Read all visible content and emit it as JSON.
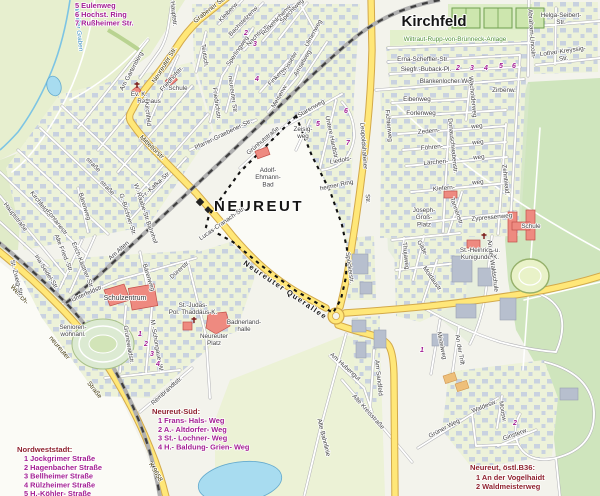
{
  "colors": {
    "road_major_fill": "#ffe778",
    "road_major_casing": "#d3a94a",
    "water": "#a8dcf0",
    "forest": "#cfe5bd",
    "residential": "#edf2d9",
    "building": "#c7d0e0",
    "landmark_red": "#ee8a80",
    "boundary": "#111111",
    "legend_magenta": "#a21a92",
    "legend_dark_red": "#8e1f2c",
    "green_label": "#4b8f2f",
    "water_label": "#3a8fc0"
  },
  "map": {
    "district_label": "NEUREUT",
    "quarter_label": "Kirchfeld",
    "labels": [
      {
        "n": "neureuter-str",
        "t": "Neureuter Str.",
        "x": 166,
        "y": 66,
        "r": -58,
        "k": "road"
      },
      {
        "n": "mitteltorstr",
        "t": "Mitteltorstr.",
        "x": 151,
        "y": 149,
        "r": 44,
        "k": "road"
      },
      {
        "n": "grabener-str",
        "t": "Grabener Str.",
        "x": 211,
        "y": 11,
        "r": -38,
        "k": "road"
      },
      {
        "n": "welsch",
        "t": "Welsch-",
        "x": 18,
        "y": 296,
        "r": 48,
        "k": "road"
      },
      {
        "n": "welsch-neureuter",
        "t": "neureuter",
        "x": 58,
        "y": 349,
        "r": 50,
        "k": "road"
      },
      {
        "n": "welsch-strasse",
        "t": "Straße",
        "x": 93,
        "y": 391,
        "r": 52,
        "k": "road"
      },
      {
        "n": "k9658",
        "t": "K 9658",
        "x": 154,
        "y": 473,
        "r": 60,
        "k": "road"
      },
      {
        "n": "neureuter-querallee",
        "t": "Neureuter Querallee",
        "x": 284,
        "y": 292,
        "r": 34,
        "k": "qall"
      },
      {
        "n": "leopoldshafener",
        "t": "Leopoldshafener",
        "x": 362,
        "y": 146,
        "r": 86
      },
      {
        "n": "leopoldshafener-str",
        "t": "Str.",
        "x": 366,
        "y": 199,
        "r": 86
      },
      {
        "n": "hauptstr-nord",
        "t": "Hauptstr.",
        "x": 172,
        "y": 14,
        "r": 84
      },
      {
        "n": "am-gartenberg",
        "t": "Am Gartenberg",
        "x": 133,
        "y": 72,
        "r": -62
      },
      {
        "n": "friedhofstr",
        "t": "Friedhofstr.",
        "x": 173,
        "y": 80,
        "r": -48
      },
      {
        "n": "schule-dorf",
        "t": "Schule",
        "x": 178,
        "y": 90
      },
      {
        "n": "ev-k",
        "t": "Ev. K.",
        "x": 139,
        "y": 96
      },
      {
        "n": "rathaus",
        "t": "Rathaus",
        "x": 149,
        "y": 103
      },
      {
        "n": "kirchfeld-vert",
        "t": "Kirchfeld",
        "x": 146,
        "y": 114,
        "r": 84
      },
      {
        "n": "hauptstrasse",
        "t": "Hauptstraße",
        "x": 14,
        "y": 218,
        "r": 52
      },
      {
        "n": "kirchfeldstr",
        "t": "Kirchfeldstr.",
        "x": 40,
        "y": 206,
        "r": 52
      },
      {
        "n": "fontanestr",
        "t": "Fontanestr.",
        "x": 56,
        "y": 224,
        "r": 52
      },
      {
        "n": "ina-seidel-str",
        "t": "Ina-Seidel-Str.",
        "x": 45,
        "y": 273,
        "r": 58
      },
      {
        "n": "st-zweig-str",
        "t": "St.-Zweig-Str.",
        "x": 15,
        "y": 279,
        "r": 76
      },
      {
        "n": "alte-fried-str",
        "t": "Alte Fried.-Str.",
        "x": 62,
        "y": 254,
        "r": 68
      },
      {
        "n": "erich-kaestner-str",
        "t": "Erich-Kästner-Str.",
        "x": 81,
        "y": 266,
        "r": 68
      },
      {
        "n": "am-alten",
        "t": "Am Alten",
        "x": 120,
        "y": 252,
        "r": -42
      },
      {
        "n": "bahnhof",
        "t": "Bahnhof",
        "x": 150,
        "y": 233,
        "r": 70
      },
      {
        "n": "unterfeldstr",
        "t": "Unterfeldstr.",
        "x": 88,
        "y": 295,
        "r": -24
      },
      {
        "n": "schulzentrum",
        "t": "Schulzentrum",
        "x": 125,
        "y": 300,
        "k": "streetb"
      },
      {
        "n": "seniorenwohnanl",
        "lines": [
          "Senioren-",
          "wohnanl."
        ],
        "x": 73,
        "y": 329
      },
      {
        "n": "baerenweg-n",
        "t": "Bärenweg",
        "x": 83,
        "y": 207,
        "r": 72
      },
      {
        "n": "baerenweg-s",
        "t": "Bärenweg",
        "x": 147,
        "y": 278,
        "r": 72
      },
      {
        "n": "duererstr",
        "t": "Dürerstr.",
        "x": 181,
        "y": 271,
        "r": -42
      },
      {
        "n": "gruenewaldstr",
        "t": "Grünewaldstr.",
        "x": 127,
        "y": 345,
        "r": 80
      },
      {
        "n": "schongauer-w",
        "t": "M.-Schongauer-W.",
        "x": 155,
        "y": 346,
        "r": 80
      },
      {
        "n": "rembrandtstr",
        "t": "Rembrandtstr.",
        "x": 168,
        "y": 392,
        "r": -42
      },
      {
        "n": "fr-kafka-str",
        "t": "Fr.-Kafka-Str.",
        "x": 157,
        "y": 186,
        "r": -42
      },
      {
        "n": "w-raabe-str",
        "t": "W.-Raabe-Str.",
        "x": 140,
        "y": 203,
        "r": 72
      },
      {
        "n": "g-buechner-str",
        "t": "G.-Büchner-Str.",
        "x": 126,
        "y": 215,
        "r": 72
      },
      {
        "n": "strasse-frag1",
        "t": "straße",
        "x": 92,
        "y": 166,
        "r": 46
      },
      {
        "n": "strasse-frag2",
        "t": "straße",
        "x": 106,
        "y": 189,
        "r": 46
      },
      {
        "n": "pfarrer-graebener-str",
        "t": "Pfarrer-Graebener-Str.",
        "x": 224,
        "y": 136,
        "r": -26
      },
      {
        "n": "gruenhutstrasse",
        "t": "Grünhutstraße",
        "x": 264,
        "y": 142,
        "r": -40
      },
      {
        "n": "teutsch",
        "t": "Teutsch.",
        "x": 203,
        "y": 56,
        "r": 82
      },
      {
        "n": "teutschneureuter-str",
        "t": "neureuter Str.",
        "x": 231,
        "y": 95,
        "r": 82
      },
      {
        "n": "friedrichstr",
        "t": "Friedrichstr.",
        "x": 215,
        "y": 104,
        "r": 82
      },
      {
        "n": "sperlingweg",
        "t": "Sperlingweg",
        "x": 239,
        "y": 52,
        "r": -56
      },
      {
        "n": "nachtigallenw",
        "t": "Nachtig.w.",
        "x": 259,
        "y": 36,
        "r": -46
      },
      {
        "n": "bachstelzenw",
        "t": "Bachstelzenw.",
        "x": 245,
        "y": 22,
        "r": -46
      },
      {
        "n": "kleiberw",
        "t": "Kleiberw.",
        "x": 230,
        "y": 13,
        "r": -46
      },
      {
        "n": "rotkehlchenw",
        "t": "Rotkehlchenw.",
        "x": 278,
        "y": 21,
        "r": -46
      },
      {
        "n": "spechtweg",
        "t": "Spechtweg",
        "x": 293,
        "y": 12,
        "r": -46
      },
      {
        "n": "ulmenweg",
        "t": "Ulmenweg",
        "x": 315,
        "y": 34,
        "r": -62
      },
      {
        "n": "drosselw",
        "t": "Drosselw.",
        "x": 291,
        "y": 64,
        "r": -60
      },
      {
        "n": "amselweg",
        "t": "Amselweg",
        "x": 304,
        "y": 64,
        "r": -60
      },
      {
        "n": "finkenw",
        "t": "Finkenw.",
        "x": 279,
        "y": 77,
        "r": -46
      },
      {
        "n": "meisenw",
        "t": "Meisenw.",
        "x": 281,
        "y": 97,
        "r": -60
      },
      {
        "n": "starenweg",
        "t": "Starenweg",
        "x": 312,
        "y": 110,
        "r": -30
      },
      {
        "n": "zeisigweg",
        "lines": [
          "Zeisig-",
          "weg"
        ],
        "x": 303,
        "y": 131
      },
      {
        "n": "untere-hardtstr",
        "t": "Untere Hardtstr.",
        "x": 330,
        "y": 138,
        "r": 78
      },
      {
        "n": "liedols",
        "t": "Liedols-",
        "x": 341,
        "y": 162,
        "r": -10
      },
      {
        "n": "heimer-ring",
        "t": "heimer Ring",
        "x": 337,
        "y": 187,
        "r": -12
      },
      {
        "n": "fichtenweg",
        "t": "Fichtenweg",
        "x": 387,
        "y": 126,
        "r": 84
      },
      {
        "n": "adolf-ehmann-bad",
        "lines": [
          "Adolf-",
          "Ehmann-",
          "Bad"
        ],
        "x": 268,
        "y": 172
      },
      {
        "n": "lucas-cranach-str",
        "t": "Lucas-Cranach-Str.",
        "x": 223,
        "y": 225,
        "r": -35
      },
      {
        "n": "spoeckerstr",
        "t": "Spöckerstr.",
        "x": 348,
        "y": 268,
        "r": 82
      },
      {
        "n": "neureuter-platz",
        "lines": [
          "Neureuter",
          "Platz"
        ],
        "x": 214,
        "y": 338
      },
      {
        "n": "badnerlandhalle",
        "lines": [
          "Badnerland-",
          "halle"
        ],
        "x": 244,
        "y": 324
      },
      {
        "n": "st-judas-thaddaeus",
        "lines": [
          "St.-Judas-",
          "Pol. Thaddäus-K."
        ],
        "x": 193,
        "y": 307
      },
      {
        "n": "wiltraut-rupp-anlage",
        "t": "Wiltraut-Rupp-von-Brünneck-Anlage",
        "x": 455,
        "y": 41,
        "k": "green"
      },
      {
        "n": "erna-scheffler-str",
        "t": "Erna-Scheffler-Str.",
        "x": 423,
        "y": 61
      },
      {
        "n": "siegfr-buback-pl",
        "t": "Siegfr.-Buback-Pl.",
        "x": 426,
        "y": 71
      },
      {
        "n": "blankenlocher-weg",
        "t": "Blankenlocher Weg",
        "x": 447,
        "y": 83
      },
      {
        "n": "helga-seibert-str",
        "lines": [
          "Helga-Seibert-",
          "Str."
        ],
        "x": 561,
        "y": 17
      },
      {
        "n": "lothar-kreyssig-str",
        "lines": [
          "Lothar-Kreyssig-",
          "Str."
        ],
        "x": 563,
        "y": 53,
        "r": -8
      },
      {
        "n": "abraham-lincoln",
        "t": "Abraham-Lincoln-",
        "x": 530,
        "y": 34,
        "r": 86
      },
      {
        "n": "eibenweg",
        "t": "Eibenweg",
        "x": 417,
        "y": 101
      },
      {
        "n": "forlenweg",
        "t": "Forlenweg",
        "x": 421,
        "y": 115
      },
      {
        "n": "zedern",
        "t": "Zedern-",
        "x": 429,
        "y": 133,
        "r": -5
      },
      {
        "n": "zedern-weg",
        "t": "weg",
        "x": 477,
        "y": 128,
        "r": -5
      },
      {
        "n": "foehren",
        "t": "Föhren-",
        "x": 432,
        "y": 149,
        "r": -5
      },
      {
        "n": "foehren-weg",
        "t": "weg",
        "x": 478,
        "y": 144,
        "r": -5
      },
      {
        "n": "laerchen",
        "t": "Lärchen-",
        "x": 436,
        "y": 164,
        "r": -5
      },
      {
        "n": "laerchen-weg",
        "t": "weg",
        "x": 479,
        "y": 159,
        "r": -5
      },
      {
        "n": "kiefern",
        "t": "Kiefern-",
        "x": 444,
        "y": 190,
        "r": -5
      },
      {
        "n": "kiefern-weg",
        "t": "weg",
        "x": 478,
        "y": 184,
        "r": -5
      },
      {
        "n": "donauschwabenstr",
        "t": "Donauschwabenstr.",
        "x": 451,
        "y": 146,
        "r": 84
      },
      {
        "n": "wacholderweg",
        "t": "Wacholderweg",
        "x": 471,
        "y": 97,
        "r": 84
      },
      {
        "n": "zirbenw",
        "t": "Zirbenw.",
        "x": 504,
        "y": 92
      },
      {
        "n": "zehntwald",
        "t": "Zehntwald.",
        "x": 504,
        "y": 180,
        "r": 84
      },
      {
        "n": "tannenstr",
        "t": "Tannenstr.",
        "x": 455,
        "y": 212,
        "r": 70
      },
      {
        "n": "zypressenweg",
        "t": "Zypressenweg",
        "x": 492,
        "y": 219,
        "r": -5
      },
      {
        "n": "joseph-gross-platz",
        "lines": [
          "Joseph-",
          "Groß-",
          "Platz"
        ],
        "x": 424,
        "y": 212
      },
      {
        "n": "gildestr",
        "t": "Gilde-",
        "x": 421,
        "y": 249,
        "r": 62
      },
      {
        "n": "thujaweg",
        "t": "Thujaweg",
        "x": 404,
        "y": 256,
        "r": 84
      },
      {
        "n": "moldaustr",
        "t": "Moldaustr.",
        "x": 431,
        "y": 280,
        "r": 55
      },
      {
        "n": "st-heinrich-kunigunde",
        "lines": [
          "St.-Heinrich-u.",
          "Kunigunde-K."
        ],
        "x": 480,
        "y": 252
      },
      {
        "n": "schule-ost",
        "t": "Schule",
        "x": 531,
        "y": 228
      },
      {
        "n": "mistelweg",
        "t": "Mistelweg",
        "x": 440,
        "y": 346,
        "r": 78
      },
      {
        "n": "an-der-trift",
        "t": "An der Trift",
        "x": 458,
        "y": 350,
        "r": 80
      },
      {
        "n": "an-der-waldschule",
        "t": "An der Waldschule",
        "x": 491,
        "y": 266,
        "r": 82
      },
      {
        "n": "am-hubengut",
        "t": "Am Hubengut",
        "x": 344,
        "y": 368,
        "r": 42
      },
      {
        "n": "am-sandfeld",
        "t": "Am Sandfeld",
        "x": 377,
        "y": 378,
        "r": 84
      },
      {
        "n": "alte-bahnlinie",
        "t": "Alte Bahnlinie",
        "x": 322,
        "y": 438,
        "r": 76
      },
      {
        "n": "alte-kreisstrasse",
        "t": "Alte Kreisstraße",
        "x": 367,
        "y": 413,
        "r": 48
      },
      {
        "n": "gruener-weg",
        "t": "Grüner Weg",
        "x": 445,
        "y": 430,
        "r": -28
      },
      {
        "n": "waldesw",
        "t": "Waldesw.",
        "x": 485,
        "y": 408,
        "r": -22
      },
      {
        "n": "moosw",
        "t": "Moosw.",
        "x": 501,
        "y": 412,
        "r": 80
      },
      {
        "n": "ginsterw",
        "t": "Ginsterw.",
        "x": 516,
        "y": 436,
        "r": -20
      },
      {
        "n": "weisser-graben",
        "t": "Weißer Graben",
        "x": 77,
        "y": 30,
        "r": 84,
        "k": "water"
      },
      {
        "n": "num-2-voegel",
        "t": "2",
        "x": 246,
        "y": 35,
        "k": "num"
      },
      {
        "n": "num-3-voegel",
        "t": "3",
        "x": 255,
        "y": 46,
        "k": "num"
      },
      {
        "n": "num-4-voegel",
        "t": "4",
        "x": 257,
        "y": 81,
        "k": "num"
      },
      {
        "n": "num-5-hardt",
        "t": "5",
        "x": 318,
        "y": 126,
        "k": "num"
      },
      {
        "n": "num-6-hardt",
        "t": "6",
        "x": 346,
        "y": 113,
        "k": "num"
      },
      {
        "n": "num-7-hardt",
        "t": "7",
        "x": 348,
        "y": 145,
        "k": "num"
      },
      {
        "n": "num-2-kirchfeld",
        "t": "2",
        "x": 458,
        "y": 70,
        "k": "num"
      },
      {
        "n": "num-3-kirchfeld",
        "t": "3",
        "x": 472,
        "y": 70,
        "k": "num"
      },
      {
        "n": "num-4-kirchfeld",
        "t": "4",
        "x": 486,
        "y": 70,
        "k": "num"
      },
      {
        "n": "num-5-kirchfeld",
        "t": "5",
        "x": 501,
        "y": 68,
        "k": "num"
      },
      {
        "n": "num-6-kirchfeld",
        "t": "6",
        "x": 514,
        "y": 68,
        "k": "num"
      },
      {
        "n": "num-1-vogelhaidt",
        "t": "1",
        "x": 422,
        "y": 352,
        "k": "num"
      },
      {
        "n": "num-2-waldmeister",
        "t": "2",
        "x": 515,
        "y": 425,
        "k": "num"
      },
      {
        "n": "num-1-sued",
        "t": "1",
        "x": 140,
        "y": 336,
        "k": "num"
      },
      {
        "n": "num-2-sued",
        "t": "2",
        "x": 146,
        "y": 346,
        "k": "num"
      },
      {
        "n": "num-3-sued",
        "t": "3",
        "x": 152,
        "y": 356,
        "k": "num"
      },
      {
        "n": "num-4-sued",
        "t": "4",
        "x": 158,
        "y": 366,
        "k": "num"
      }
    ],
    "legends": [
      {
        "n": "legend-top-left",
        "item_x": 75,
        "item_y": 8,
        "step": 8.8,
        "items": [
          "5  Eulenweg",
          "6  Hochst. Ring",
          "7  Rußheimer Str."
        ],
        "item_color": "#a21a92"
      },
      {
        "n": "legend-nordweststadt",
        "x": 17,
        "y": 452,
        "header": "Nordweststadt:",
        "header_color": "#8e1f2c",
        "item_x": 24,
        "item_y": 461,
        "step": 8.8,
        "items": [
          "1  Jockgrimer Straße",
          "2  Hagenbacher Straße",
          "3  Bellheimer Straße",
          "4  Rülzheimer Straße",
          "5  H.-Köhler- Straße"
        ],
        "item_color": "#a21a92"
      },
      {
        "n": "legend-neureut-sued",
        "x": 152,
        "y": 414,
        "header": "Neureut-Süd:",
        "header_color": "#8e1f2c",
        "item_x": 158,
        "item_y": 423,
        "step": 8.8,
        "items": [
          "1  Frans- Hals- Weg",
          "2  A.- Altdorfer- Weg",
          "3  St.- Lochner- Weg",
          "4  H.- Baldung- Grien- Weg"
        ],
        "item_color": "#a21a92"
      },
      {
        "n": "legend-neureut-oestl-b36",
        "x": 470,
        "y": 470,
        "header": "Neureut, östl.B36:",
        "header_color": "#8e1f2c",
        "item_x": 476,
        "item_y": 480,
        "step": 9,
        "items": [
          "1  An der Vogelhaidt",
          "2  Waldmeisterweg"
        ],
        "item_color": "#8e1f2c"
      }
    ]
  }
}
